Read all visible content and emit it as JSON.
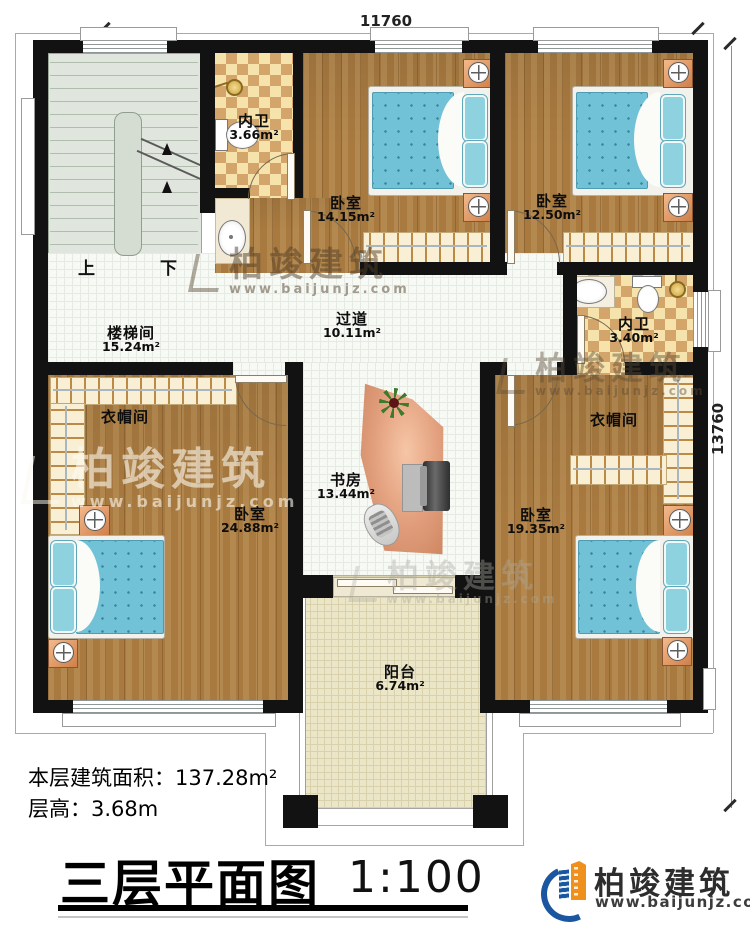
{
  "dimensions": {
    "top": "11760",
    "right": "13760"
  },
  "rooms": {
    "stairwell": {
      "name": "楼梯间",
      "area": "15.24m²"
    },
    "corridor": {
      "name": "过道",
      "area": "10.11m²"
    },
    "bath_top": {
      "name": "内卫",
      "area": "3.66m²"
    },
    "bedroom_top_mid": {
      "name": "卧室",
      "area": "14.15m²"
    },
    "bedroom_top_right": {
      "name": "卧室",
      "area": "12.50m²"
    },
    "bath_right": {
      "name": "内卫",
      "area": "3.40m²"
    },
    "closet_left": {
      "name": "衣帽间"
    },
    "bedroom_bottom_left": {
      "name": "卧室",
      "area": "24.88m²"
    },
    "study": {
      "name": "书房",
      "area": "13.44m²"
    },
    "bedroom_bottom_right": {
      "name": "卧室",
      "area": "19.35m²"
    },
    "closet_right": {
      "name": "衣帽间"
    },
    "balcony": {
      "name": "阳台",
      "area": "6.74m²"
    }
  },
  "stairs": {
    "up": "上",
    "down": "下"
  },
  "info": {
    "floor_area": "本层建筑面积：137.28m²",
    "floor_height": "层高：3.68m"
  },
  "title": {
    "name": "三层平面图",
    "scale": "1:100"
  },
  "brand": {
    "name": "柏竣建筑",
    "url": "www.baijunjz.com"
  },
  "watermark": {
    "name": "柏竣建筑",
    "url": "www.baijunjz.com"
  },
  "colors": {
    "wall": "#121212",
    "wood": "#a87a40",
    "checker": "#d4a56a",
    "mattress": "#72c2d7",
    "brand_blue": "#1a57a0",
    "brand_orange": "#ef8f1c"
  }
}
